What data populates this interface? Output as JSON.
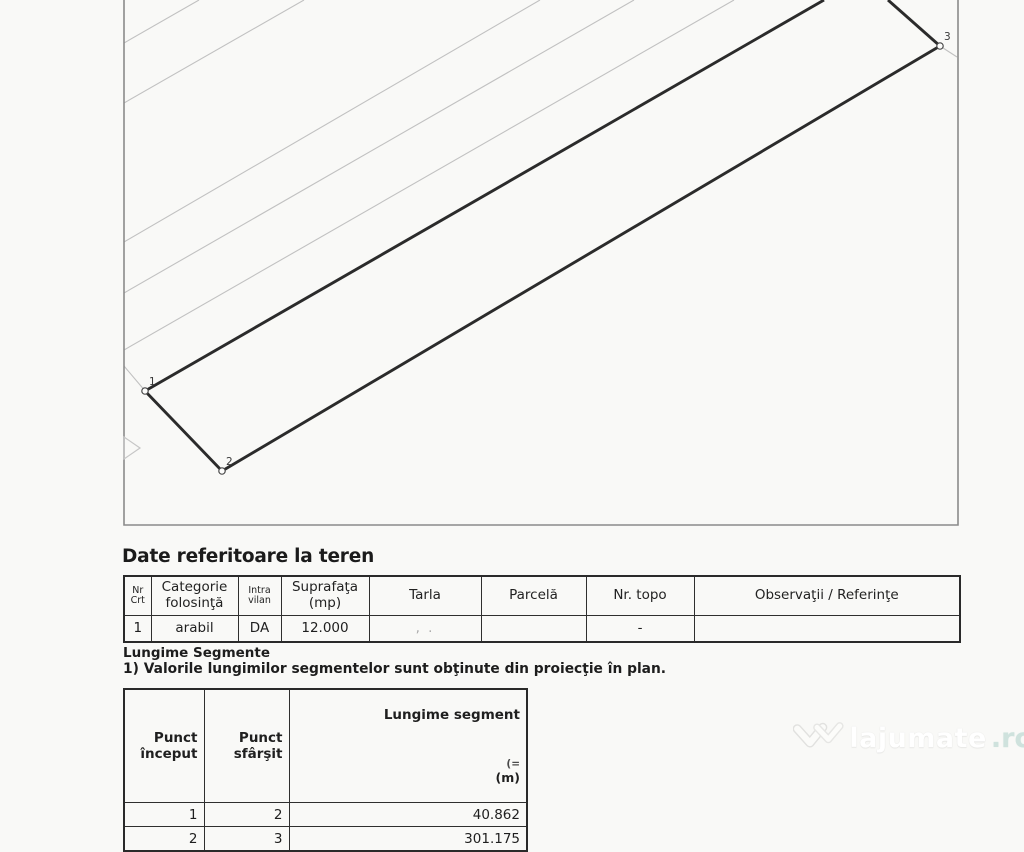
{
  "plan": {
    "colors": {
      "parcel": "#2b2b2b",
      "contour": "#c1c1c1",
      "frame": "#8b8b8b",
      "label": "#3a3a3a"
    },
    "frame": {
      "left": 124,
      "right": 958,
      "bottom": 525
    },
    "contour_lines": [
      [
        124,
        43,
        199,
        0
      ],
      [
        124,
        103,
        304,
        0
      ],
      [
        124,
        242,
        540,
        0
      ],
      [
        124,
        293,
        634,
        0
      ],
      [
        124,
        350,
        734,
        0
      ],
      [
        124,
        366,
        146,
        392
      ],
      [
        940,
        46,
        957,
        57
      ]
    ],
    "parcel_edges": [
      [
        145,
        391,
        824,
        0
      ],
      [
        940,
        46,
        888,
        0
      ],
      [
        145,
        391,
        222,
        471
      ],
      [
        222,
        471,
        940,
        46
      ]
    ],
    "vertices": [
      {
        "label": "1",
        "x": 145,
        "y": 391
      },
      {
        "label": "2",
        "x": 222,
        "y": 471
      },
      {
        "label": "3",
        "x": 940,
        "y": 46
      }
    ],
    "chevron": "124,437 140,448 124,459"
  },
  "terrain": {
    "title": "Date referitoare la teren",
    "table": {
      "headers": [
        "Nr\nCrt",
        "Categorie\nfolosinţă",
        "Intra\nvilan",
        "Suprafaţa\n(mp)",
        "Tarla",
        "Parcelă",
        "Nr. topo",
        "Observaţii / Referinţe"
      ],
      "row": {
        "nr_crt": "1",
        "categorie": "arabil",
        "intravilan": "DA",
        "suprafata": "12.000",
        "tarla_mark": ", .",
        "parcela": "",
        "nr_topo": "-",
        "observatii": ""
      }
    }
  },
  "segments": {
    "title": "Lungime Segmente",
    "note": "1) Valorile lungimilor segmentelor sunt obţinute din proiecţie în plan.",
    "table": {
      "headers": [
        "Punct\nînceput",
        "Punct\nsfârşit",
        "Lungime segment"
      ],
      "unit_artifact": "(=",
      "unit": "(m)",
      "rows": [
        {
          "start": "1",
          "end": "2",
          "length": "40.862"
        },
        {
          "start": "2",
          "end": "3",
          "length": "301.175"
        }
      ]
    }
  },
  "watermark": {
    "brand": "lajumate",
    "tld": ".ro"
  }
}
